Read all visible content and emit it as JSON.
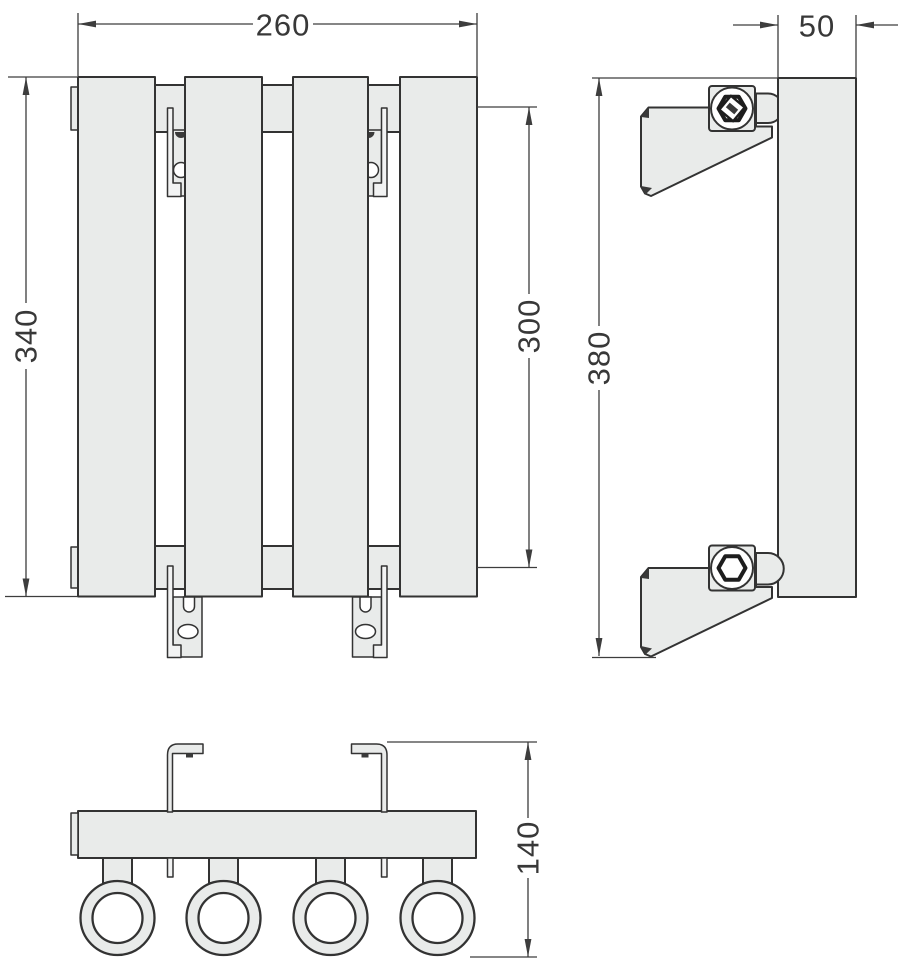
{
  "views": {
    "front": {
      "dimensions": {
        "width": "260",
        "height": "340",
        "connection_spacing": "300"
      }
    },
    "side": {
      "dimensions": {
        "depth": "50",
        "overall_height": "380"
      }
    },
    "bottom": {
      "dimensions": {
        "mounting_depth": "140"
      }
    }
  },
  "colors": {
    "part_fill": "#e9ebea",
    "bracket_fill": "#f2f3f3",
    "outline": "#333333",
    "dimension_lines": "#3d3d3d",
    "background": "#ffffff"
  }
}
